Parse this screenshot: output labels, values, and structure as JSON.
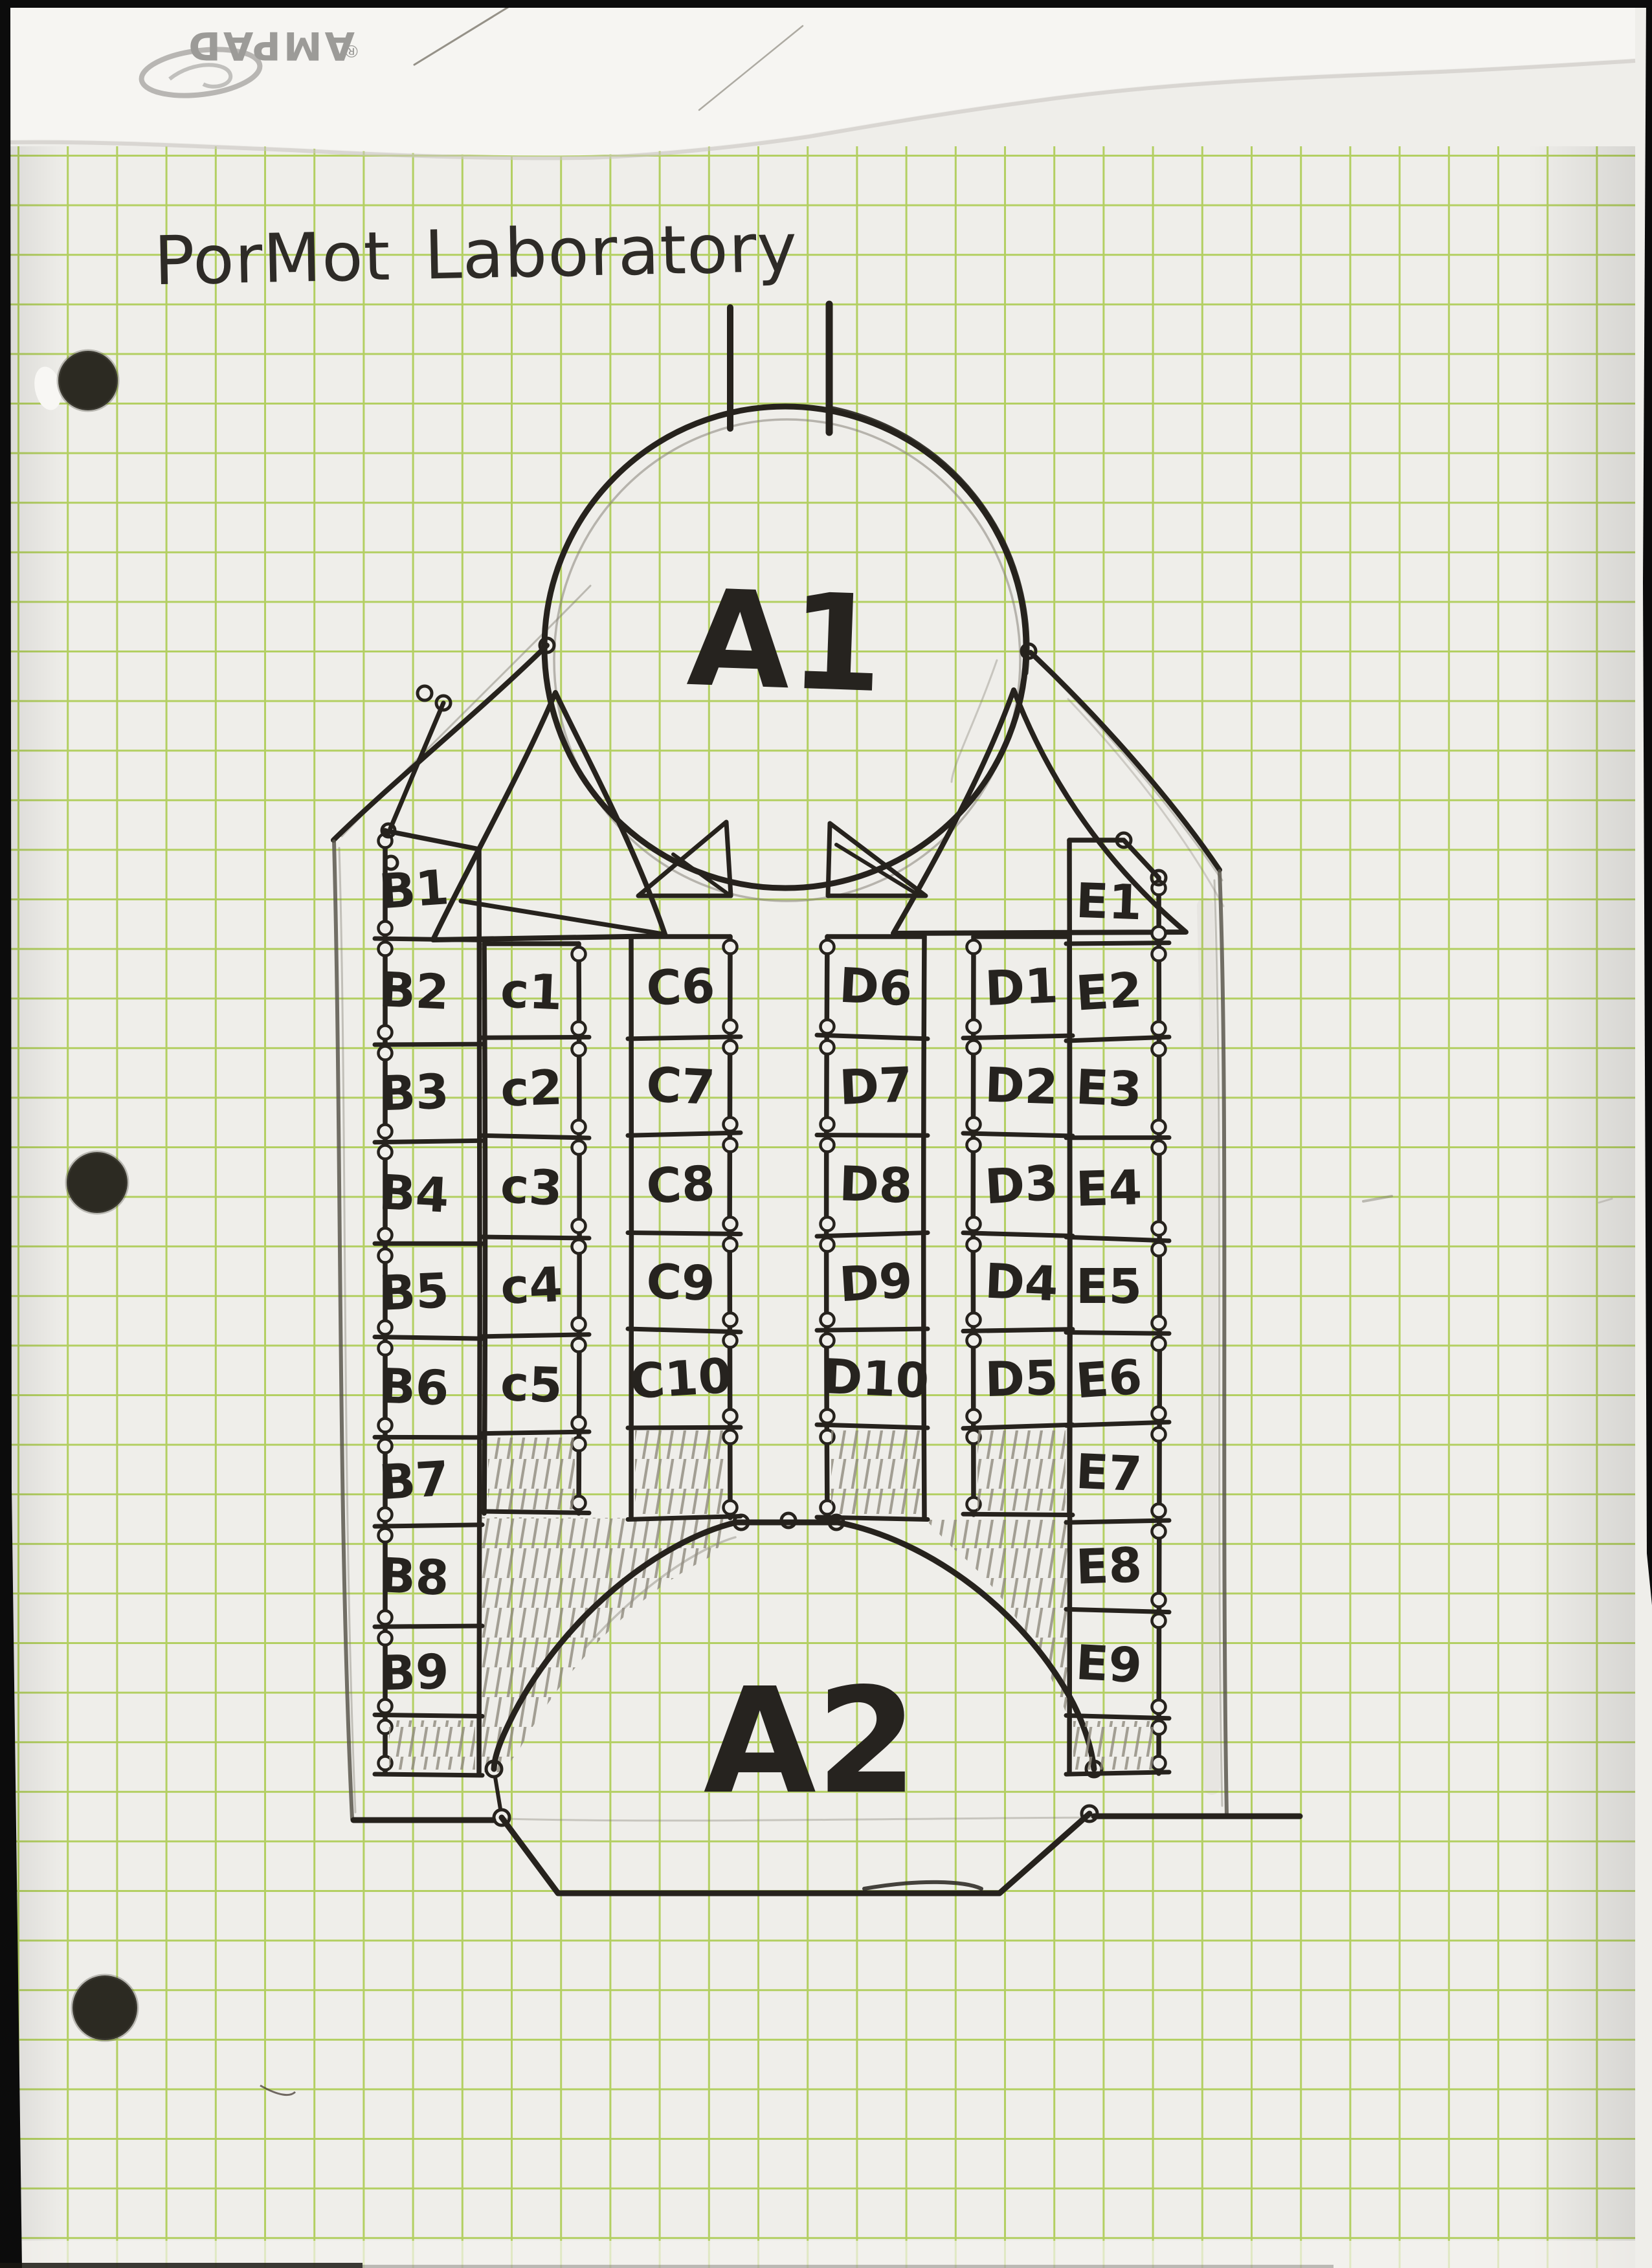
{
  "scan": {
    "brand_stamp": "AMPAD",
    "brand_reg": "®"
  },
  "page": {
    "title": "PorMot Laboratory"
  },
  "rooms": {
    "a1": "A1",
    "a2": "A2"
  },
  "cell_columns": [
    {
      "id": "B",
      "labels": [
        "B1",
        "B2",
        "B3",
        "B4",
        "B5",
        "B6",
        "B7",
        "B8",
        "B9"
      ]
    },
    {
      "id": "C_outer",
      "labels": [
        "c1",
        "c2",
        "c3",
        "c4",
        "c5"
      ]
    },
    {
      "id": "C_inner",
      "labels": [
        "C6",
        "C7",
        "C8",
        "C9",
        "C10"
      ]
    },
    {
      "id": "D_inner",
      "labels": [
        "D6",
        "D7",
        "D8",
        "D9",
        "D10"
      ]
    },
    {
      "id": "D_outer",
      "labels": [
        "D1",
        "D2",
        "D3",
        "D4",
        "D5"
      ]
    },
    {
      "id": "E",
      "labels": [
        "E1",
        "E2",
        "E3",
        "E4",
        "E5",
        "E6",
        "E7",
        "E8",
        "E9"
      ]
    }
  ]
}
